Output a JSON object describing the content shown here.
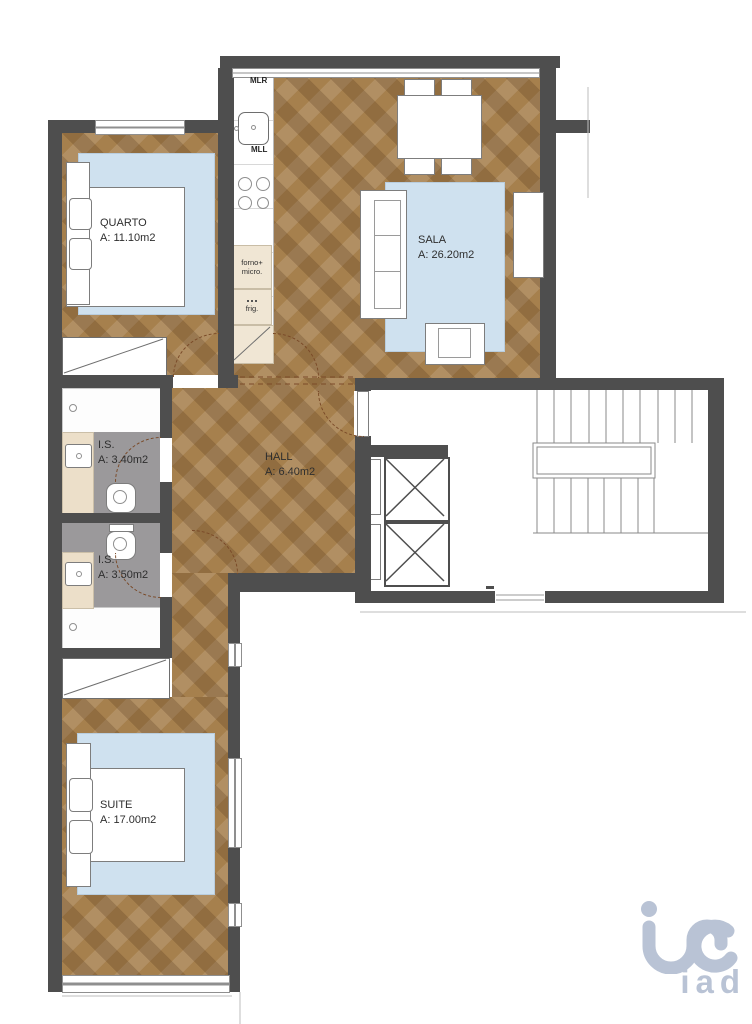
{
  "rooms": [
    {
      "id": "quarto",
      "name": "QUARTO",
      "area": "A: 11.10m2"
    },
    {
      "id": "sala",
      "name": "SALA",
      "area": "A: 26.20m2"
    },
    {
      "id": "is1",
      "name": "I.S.",
      "area": "A: 3.40m2"
    },
    {
      "id": "hall",
      "name": "HALL",
      "area": "A: 6.40m2"
    },
    {
      "id": "is2",
      "name": "I.S.",
      "area": "A: 3.50m2"
    },
    {
      "id": "suite",
      "name": "SUITE",
      "area": "A: 17.00m2"
    }
  ],
  "kitchen": {
    "washer_label": "MLR",
    "dishwasher_label": "MLL",
    "oven_label_line1": "forno+",
    "oven_label_line2": "micro.",
    "fridge_label": "frig."
  },
  "logo": {
    "brand": "iad"
  },
  "colors": {
    "wall": "#4e4e4e",
    "wood": "#a6804d",
    "rug": "#cfe1ef",
    "bath_floor": "#9b999b",
    "counter": "#ecdfc9",
    "appliance_cell": "#f0e6d4",
    "door_arc": "#7a4a28",
    "logo": "#b9c3d5",
    "line": "#9a9a9a"
  }
}
